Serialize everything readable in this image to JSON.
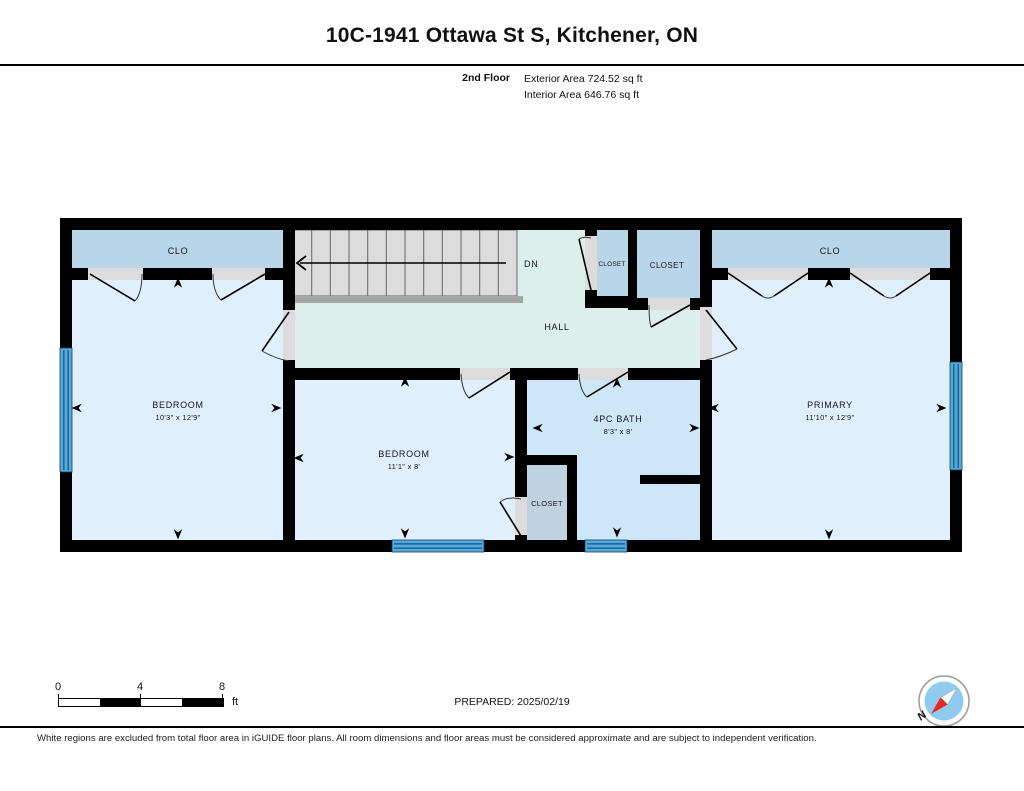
{
  "header": {
    "title": "10C-1941 Ottawa St S, Kitchener, ON",
    "floor_label": "2nd Floor",
    "exterior_area": "Exterior Area 724.52 sq ft",
    "interior_area": "Interior Area 646.76 sq ft"
  },
  "rooms": {
    "clo_left": {
      "label": "CLO"
    },
    "bedroom_left": {
      "label": "BEDROOM",
      "dims": "10'3\" x 12'9\""
    },
    "stairs": {
      "label": "DN"
    },
    "hall": {
      "label": "HALL"
    },
    "closet_small": {
      "label": "CLOSET"
    },
    "closet_mid": {
      "label": "CLOSET"
    },
    "clo_right": {
      "label": "CLO"
    },
    "primary": {
      "label": "PRIMARY",
      "dims": "11'10\" x 12'9\""
    },
    "bedroom_mid": {
      "label": "BEDROOM",
      "dims": "11'1\" x 8'"
    },
    "bath": {
      "label": "4PC BATH",
      "dims": "8'3\" x 8'"
    },
    "closet_bath": {
      "label": "CLOSET"
    }
  },
  "scale_bar": {
    "tick0": "0",
    "tick1": "4",
    "tick2": "8",
    "unit": "ft"
  },
  "compass": {
    "north_label": "N"
  },
  "footer": {
    "prepared": "PREPARED: 2025/02/19",
    "disclaimer": "White regions are excluded from total floor area in iGUIDE floor plans. All room dimensions and floor areas must be considered approximate and are subject to independent verification."
  },
  "colors": {
    "wall": "#000000",
    "room_fill": "#dff0fc",
    "closet_fill": "#b9d5ea",
    "closet_bath_fill": "#bed2e2",
    "bath_fill": "#cde7f8",
    "hall_fill": "#dcefeb",
    "stairs_fill": "#dcdcdc",
    "stair_edge": "#a6a6a6",
    "window_fill": "#57a9da",
    "door_opening": "#dcdcdc",
    "compass_red": "#e8251f",
    "compass_blue": "#8ecbee"
  }
}
